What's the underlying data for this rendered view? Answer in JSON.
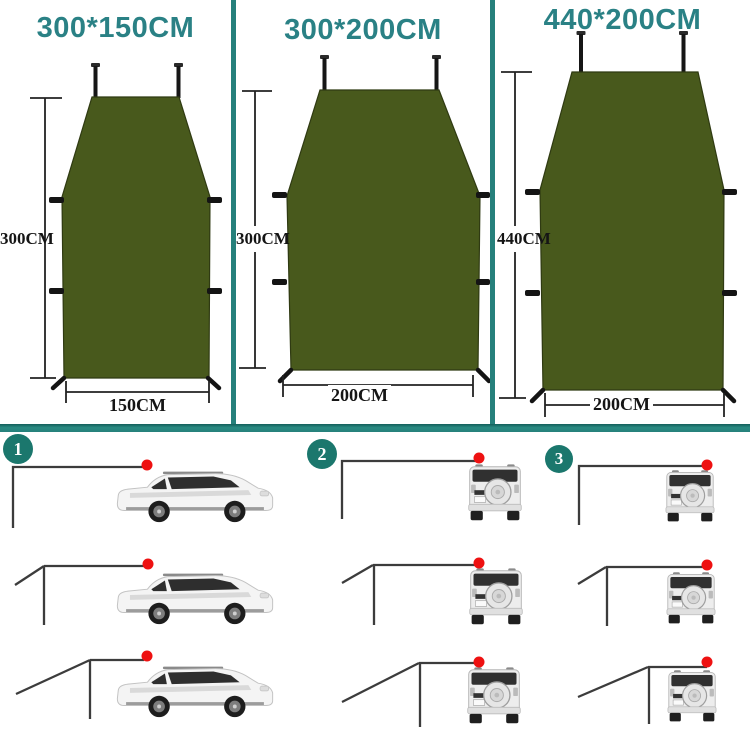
{
  "page_title": "Car side awning tarp sizes and setup options",
  "colors": {
    "accent_teal": "#2a8185",
    "divider_teal": "#26807b",
    "badge_teal": "#1b776d",
    "tarp_green": "#48591c",
    "marker_red": "#ee1111",
    "dimension_text": "#151515",
    "frame_line_gray": "#3c3c3c"
  },
  "panels": [
    {
      "title": "300*150CM",
      "height_label": "300CM",
      "width_label": "150CM"
    },
    {
      "title": "300*200CM",
      "height_label": "300CM",
      "width_label": "200CM"
    },
    {
      "title": "440*200CM",
      "height_label": "440CM",
      "width_label": "200CM"
    }
  ],
  "steps": [
    {
      "number": "1"
    },
    {
      "number": "2"
    },
    {
      "number": "3"
    }
  ],
  "icons": {
    "tarp-shape": "dark olive trapezoid tarp",
    "dimension-arrow": "line with end ticks",
    "roof-attach-marker": "red dot",
    "suv-side": "side view SUV illustration",
    "suv-rear": "rear view SUV with spare tire"
  }
}
